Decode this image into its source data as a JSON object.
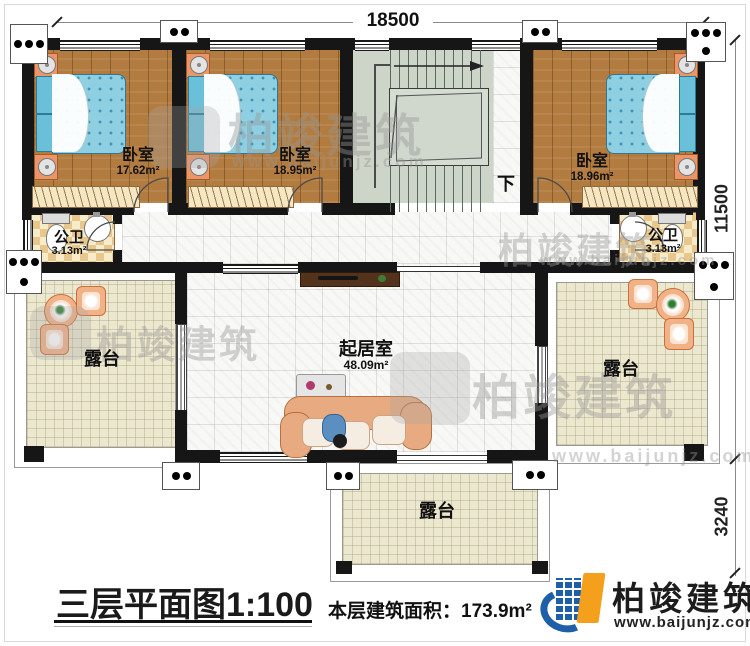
{
  "meta": {
    "title_text": "三层平面图1:100",
    "area_note": "本层建筑面积：173.9m²"
  },
  "dimensions": {
    "top": "18500",
    "right_upper": "11500",
    "right_lower": "3240"
  },
  "rooms": {
    "bedroom_left": {
      "name": "卧室",
      "area": "17.62m²"
    },
    "bedroom_middle": {
      "name": "卧室",
      "area": "18.95m²"
    },
    "bedroom_right": {
      "name": "卧室",
      "area": "18.96m²"
    },
    "bathroom_left": {
      "name": "公卫",
      "area": "3.13m²"
    },
    "bathroom_right": {
      "name": "公卫",
      "area": "3.13m²"
    },
    "living_room": {
      "name": "起居室",
      "area": "48.09m²"
    },
    "terrace_left": {
      "name": "露台"
    },
    "terrace_right": {
      "name": "露台"
    },
    "terrace_bottom": {
      "name": "露台"
    },
    "stair_direction": "下"
  },
  "branding": {
    "company": "柏竣建筑",
    "website": "www.baijunjz.com"
  },
  "colors": {
    "wall": "#161616",
    "wood_floor": "#b27c40",
    "mattress_blue": "#8ecfe2",
    "terrace_beige": "#ece7cf",
    "stair_sage": "#cdd5c8",
    "bath_checker": "#e9c68c",
    "logo_blue": "#1e5fa8",
    "logo_orange": "#f5a01c"
  }
}
